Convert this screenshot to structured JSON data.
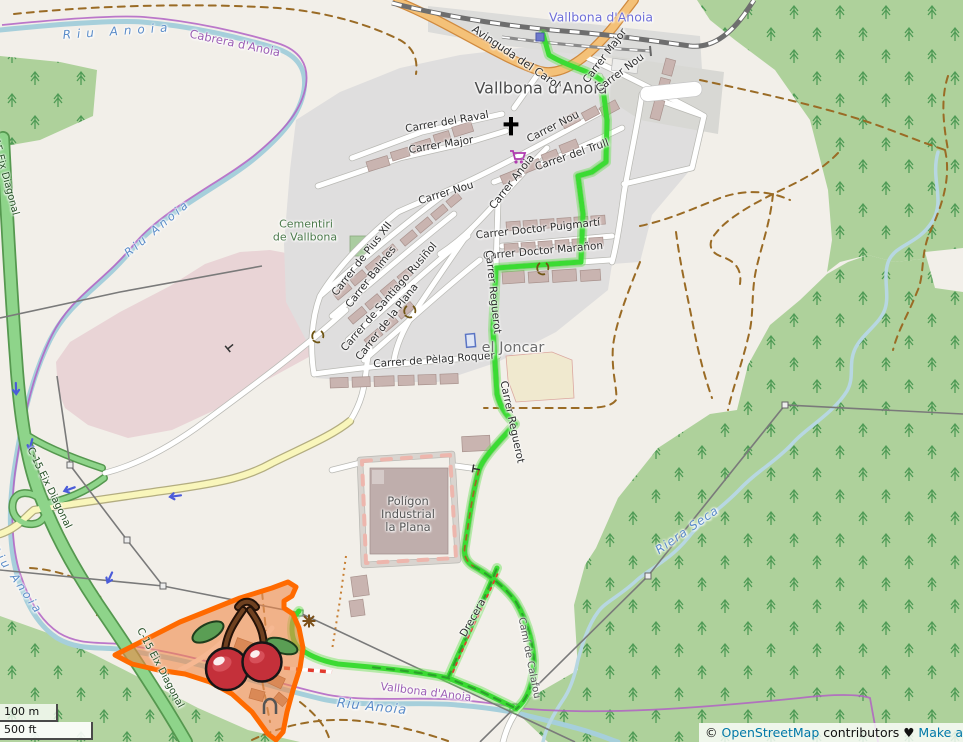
{
  "labels": {
    "riuAnoiaTop": "Riu Anoia",
    "cabrera": "Cabrera d'Anoia",
    "riuAnoiaMid": "Riu Anoia",
    "riuAnoiaLeft": "Riu Anoia",
    "riuAnoiaBottom": "Riu Anoia",
    "rieraSeca": "Riera Seca",
    "vallbonaBoundary": "Vallbona d'Anoia",
    "stationName": "Vallbona d'Anoia",
    "townName": "Vallbona d'Anoia",
    "c15Top": "C-15 Eix Diagonal",
    "c15Mid": "C-15 Eix Diagonal",
    "c15Low": "C-15 Eix Diagonal",
    "avinguda": "Avinguda del Carol",
    "carrerMajorNE": "Carrer Major",
    "carrerNouTR": "Carrer Nou",
    "carrerRaval": "Carrer del Raval",
    "carrerMajor2": "Carrer Major",
    "carrerNouMid": "Carrer Nou",
    "carrerTrull": "Carrer del Trull",
    "carrerNouLow": "Carrer Nou",
    "carrerAnoia": "Carrer Anoia",
    "puigmarti": "Carrer Doctor Puigmartí",
    "maranon": "Carrer Doctor Marañon",
    "pius": "Carrer de Pius XII",
    "balmes": "Carrer Balmes",
    "rusinol": "Carrer de Santiago Rusiñol",
    "plana": "Carrer de la Plana",
    "pelag": "Carrer de Pèlag Roquer",
    "reguerotUp": "Carrer Reguerot",
    "reguerotLow": "Carrer Reguerot",
    "cementiriLine1": "Cementiri",
    "cementiriLine2": "de Vallbona",
    "elJoncar": "el Joncar",
    "poligonLine1": "Polígon",
    "poligonLine2": "Industrial",
    "poligonLine3": "la Plana",
    "drecera": "Drecera",
    "camiCalafou": "Camí de Calafou"
  },
  "scale": {
    "metric": "100 m",
    "imperial": "500 ft"
  },
  "attribution": {
    "copyright": "© ",
    "osm_link": "OpenStreetMap",
    "contributors": " contributors ",
    "heart": "♥",
    "make_link": " Make a"
  },
  "icons": {
    "church": "church-cross-icon",
    "supermarket": "shopping-cart-icon",
    "recycling": "recycling-icon",
    "station": "railway-station-icon",
    "oneway": "oneway-arrow-icon",
    "cherries": "cherries-marker-icon"
  },
  "colors": {
    "route": "#3bdb33",
    "highlight_outline": "#ff6a00",
    "highlight_fill": "#f0894a",
    "water": "#a6cfdb",
    "forest": "#aed19b",
    "trunk_road": "#8ed48a",
    "primary_road": "#f4c178",
    "boundary": "#b161c4"
  }
}
